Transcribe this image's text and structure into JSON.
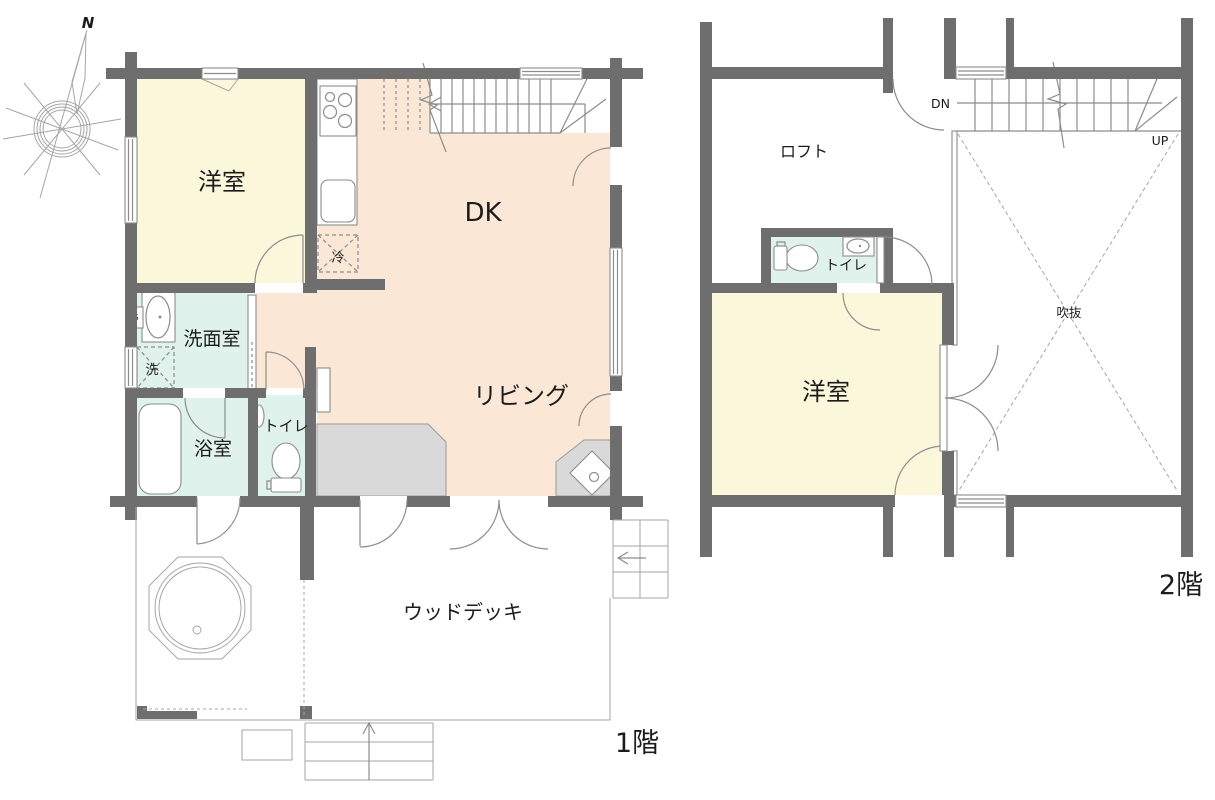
{
  "compass": {
    "north": "N"
  },
  "palette": {
    "wall": "#6e6e6e",
    "room_cream": "#faf7da",
    "room_peach": "#fbe7d6",
    "room_cyan": "#dff2ec",
    "floor_gray": "#d9d9d9",
    "line_gray": "#8c8c8c"
  },
  "floor1": {
    "caption": "1階",
    "rooms": {
      "bedroom": "洋室",
      "dining_kitchen": "DK",
      "living": "リビング",
      "washroom": "洗面室",
      "bathroom": "浴室",
      "toilet": "トイレ",
      "wood_deck": "ウッドデッキ"
    },
    "fixtures": {
      "refrigerator": "冷",
      "washing_machine": "洗",
      "pipe_space": "PS"
    }
  },
  "floor2": {
    "caption": "2階",
    "rooms": {
      "loft": "ロフト",
      "toilet": "トイレ",
      "bedroom": "洋室",
      "atrium_void": "吹抜"
    },
    "stairs": {
      "down": "DN",
      "up": "UP"
    }
  }
}
